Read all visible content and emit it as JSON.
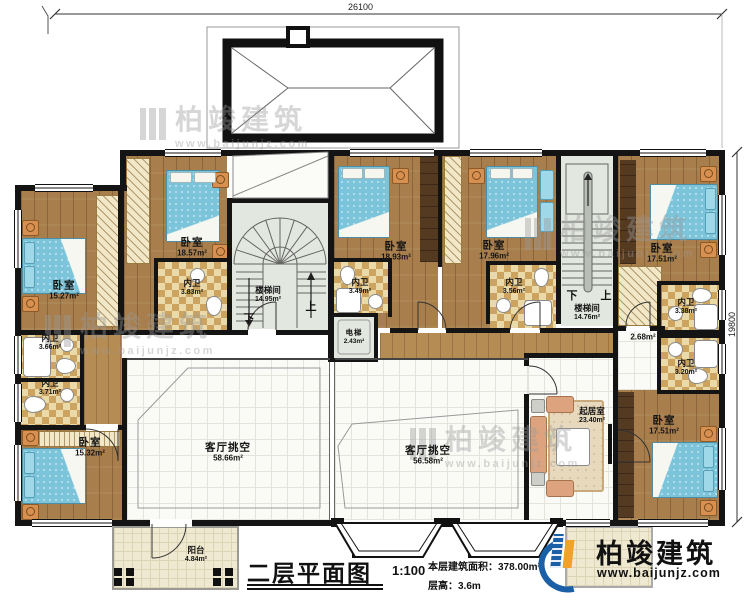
{
  "dimensions": {
    "top": "26100",
    "right": "19800"
  },
  "stair_labels": {
    "up": "上",
    "down": "下"
  },
  "rooms": {
    "bedroom_tl": {
      "name": "卧室",
      "area": "15.27m²"
    },
    "bedroom_l2": {
      "name": "卧室",
      "area": "18.57m²"
    },
    "bath_l2": {
      "name": "内卫",
      "area": "3.83m²"
    },
    "bath_l3": {
      "name": "内卫",
      "area": "3.66m²"
    },
    "bath_l4": {
      "name": "内卫",
      "area": "3.71m²"
    },
    "bedroom_bl": {
      "name": "卧室",
      "area": "15.32m²"
    },
    "stairwell_left": {
      "name": "楼梯间",
      "area": "14.95m²"
    },
    "elevator": {
      "name": "电梯",
      "area": "2.43m²"
    },
    "bedroom_m": {
      "name": "卧室",
      "area": "18.93m²"
    },
    "bath_m": {
      "name": "内卫",
      "area": "3.49m²"
    },
    "living_void_left": {
      "name": "客厅挑空",
      "area": "58.66m²"
    },
    "living_void_right": {
      "name": "客厅挑空",
      "area": "56.58m²"
    },
    "bedroom_mr": {
      "name": "卧室",
      "area": "17.96m²"
    },
    "bath_mr": {
      "name": "内卫",
      "area": "3.56m²"
    },
    "stairwell_right": {
      "name": "楼梯间",
      "area": "14.76m²"
    },
    "hall": {
      "area": "2.68m²"
    },
    "bedroom_tr": {
      "name": "卧室",
      "area": "17.51m²"
    },
    "bath_r1": {
      "name": "内卫",
      "area": "3.38m²"
    },
    "bath_r2": {
      "name": "内卫",
      "area": "3.20m²"
    },
    "bedroom_br": {
      "name": "卧室",
      "area": "17.51m²"
    },
    "family_room": {
      "name": "起居室",
      "area": "23.40m²"
    },
    "balcony": {
      "name": "阳台",
      "area": "4.84m²"
    }
  },
  "titleblock": {
    "title": "二层平面图",
    "scale": "1:100",
    "area": "本层建筑面积：378.00m²",
    "floor_height": "层高：3.6m"
  },
  "brand": {
    "name": "柏竣建筑",
    "url": "www.baijunjz.com"
  },
  "watermark": {
    "name": "柏竣建筑",
    "url": "www.baijunjz.com"
  },
  "colors": {
    "wall": "#141414",
    "wood_floor": "#a87e4c",
    "bath_tile": "#cda45f",
    "stair_floor": "#e2e7df",
    "void_floor": "#fafaf6",
    "bed_blue": "#7cc4da",
    "nightstand_orange": "#d7904f",
    "sofa_salmon": "#dca37e",
    "brand_blue": "#1b5fa6",
    "brand_orange": "#f0a229"
  }
}
